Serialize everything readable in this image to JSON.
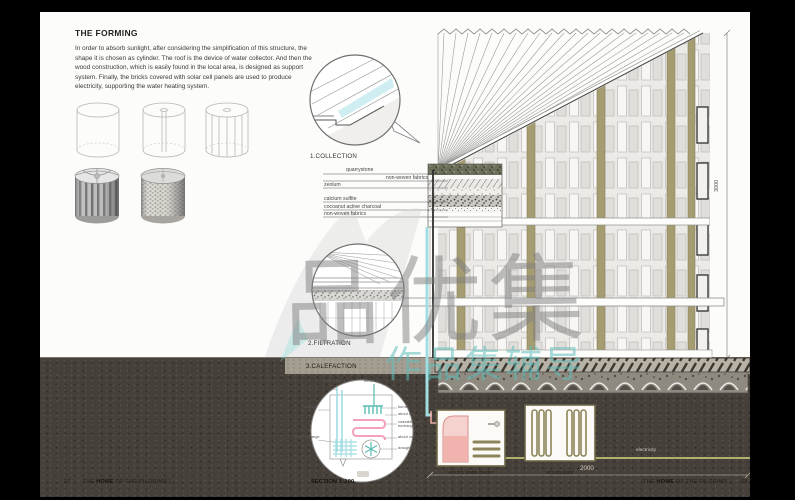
{
  "left_panel": {
    "title": "THE FORMING",
    "body": "In order to absorb sunlight, after considering the simplification of this structure, the shape it is chosen as cylinder. The roof is the device of water collector. And then the wood construction, which is easily found in the local area, is designed as support system. Finally, the bricks covered with solar cell panels are used to produce electricity, supporting the water heating system."
  },
  "steps": {
    "collection": "1.COLLECTION",
    "filtration": "2.FILTRATION",
    "calefaction": "3.CALEFACTION"
  },
  "roof_layers": [
    "quarrystone",
    "non-woven fabrics",
    "zeolum",
    "calcium sulfite",
    "cocoanut active charcoal",
    "non-woven fabrics"
  ],
  "calefaction": {
    "cold_water": "cold water",
    "electricity": "electricity",
    "storage": "storage",
    "heat_exchange": "heat exchange",
    "burner": "burner",
    "coil_top": "about coil",
    "exchanger": "coaxable heat exchanger",
    "coil_bottom": "about coil",
    "draught_fan": "draught fan"
  },
  "section": {
    "height_dim": "3000",
    "width_dim": "2000",
    "water_heater": "electric water heater",
    "accumulator": "accumulator",
    "electricity": "electricity"
  },
  "footer": {
    "page_left": "07",
    "title_prefix": "THE ",
    "title_bold": "HOME",
    "title_suffix": " OF THE PILGRIMS |",
    "scale": "SECTION 1:100",
    "page_right": "08"
  },
  "watermark": {
    "big": "品优集",
    "small": "作品集辅导"
  }
}
